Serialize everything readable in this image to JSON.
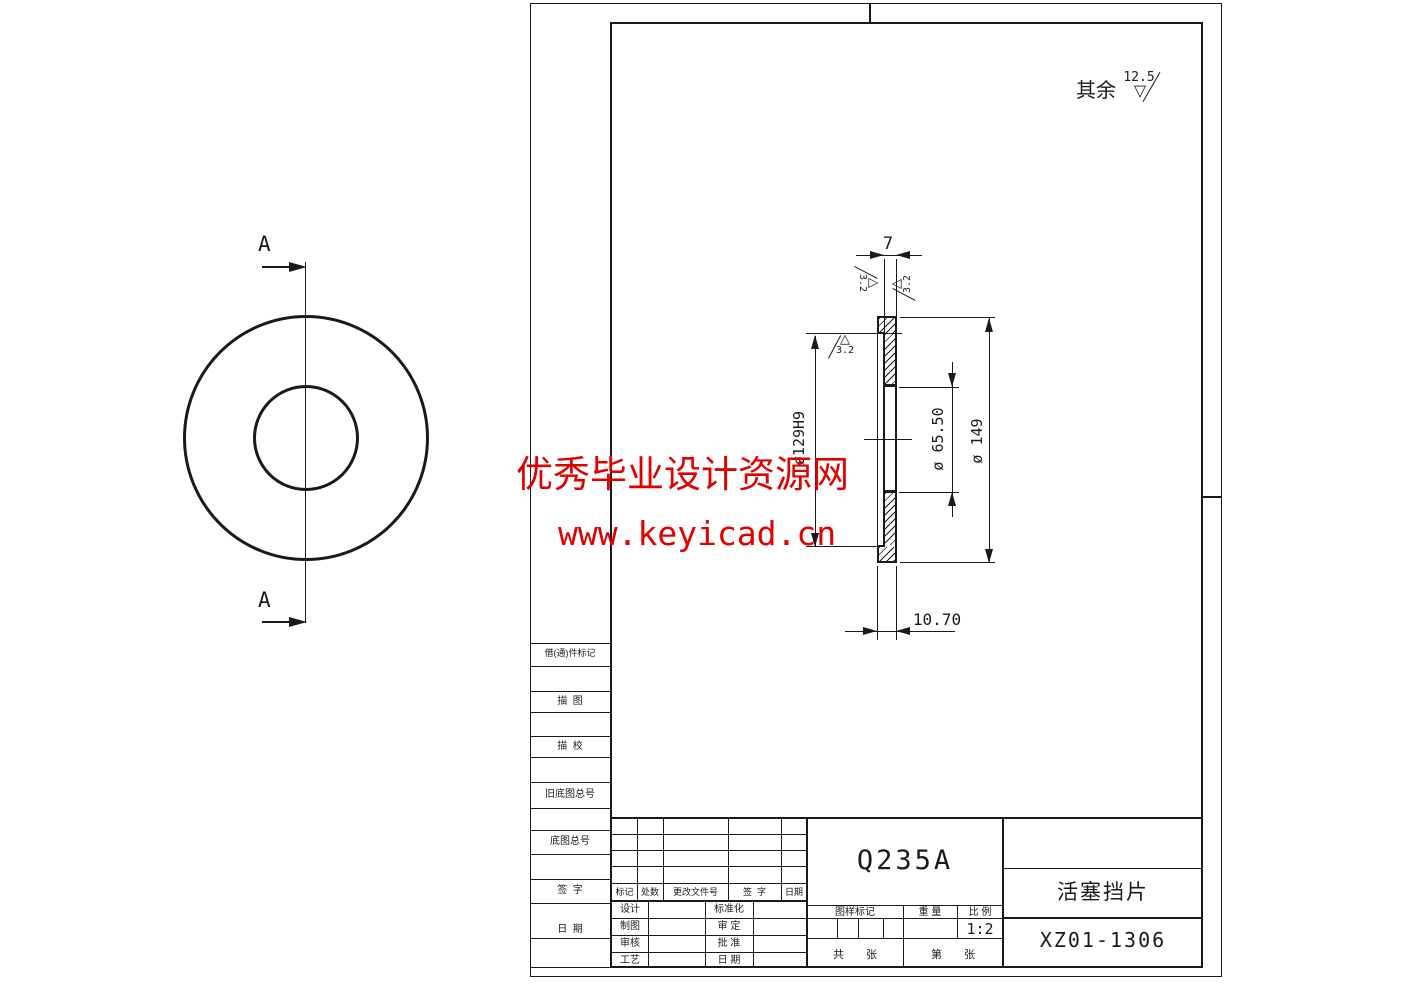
{
  "watermark": {
    "line1": "优秀毕业设计资源网",
    "line2": "www.keyicad.cn",
    "color": "#e00000"
  },
  "note": {
    "prefix": "其余",
    "value": "12.5"
  },
  "glyphs": {
    "tri_up": "△",
    "tri_down": "▽"
  },
  "left_view": {
    "section_label": "A"
  },
  "dims": {
    "web_thickness": "7",
    "recess_dia": "ø129H9",
    "hole_dia": "ø 65.50",
    "outer_dia": "ø 149",
    "total_thickness": "10.70",
    "roughness": "3.2"
  },
  "title_block": {
    "material": "Q235A",
    "part_name": "活塞挡片",
    "drawing_no": "XZ01-1306",
    "mark_label": "图样标记",
    "weight_label": "重 量",
    "scale_label": "比 例",
    "scale_value": "1:2",
    "sheets_total": "共　　张",
    "sheet_no": "第　　张",
    "rev": {
      "c1": "标记",
      "c2": "处数",
      "c3": "更改文件号",
      "c4": "签  字",
      "c5": "日期"
    },
    "roles": {
      "l1": "设计",
      "l2": "制图",
      "l3": "审核",
      "l4": "工艺",
      "r1": "标准化",
      "r2": "审 定",
      "r3": "批 准",
      "r4": "日 期"
    }
  },
  "side_column": {
    "r1": "借(通)件标记",
    "r2": "描  图",
    "r3": "描  校",
    "r4": "旧底图总号",
    "r5": "底图总号",
    "r6": "签  字",
    "r7": "日  期"
  }
}
